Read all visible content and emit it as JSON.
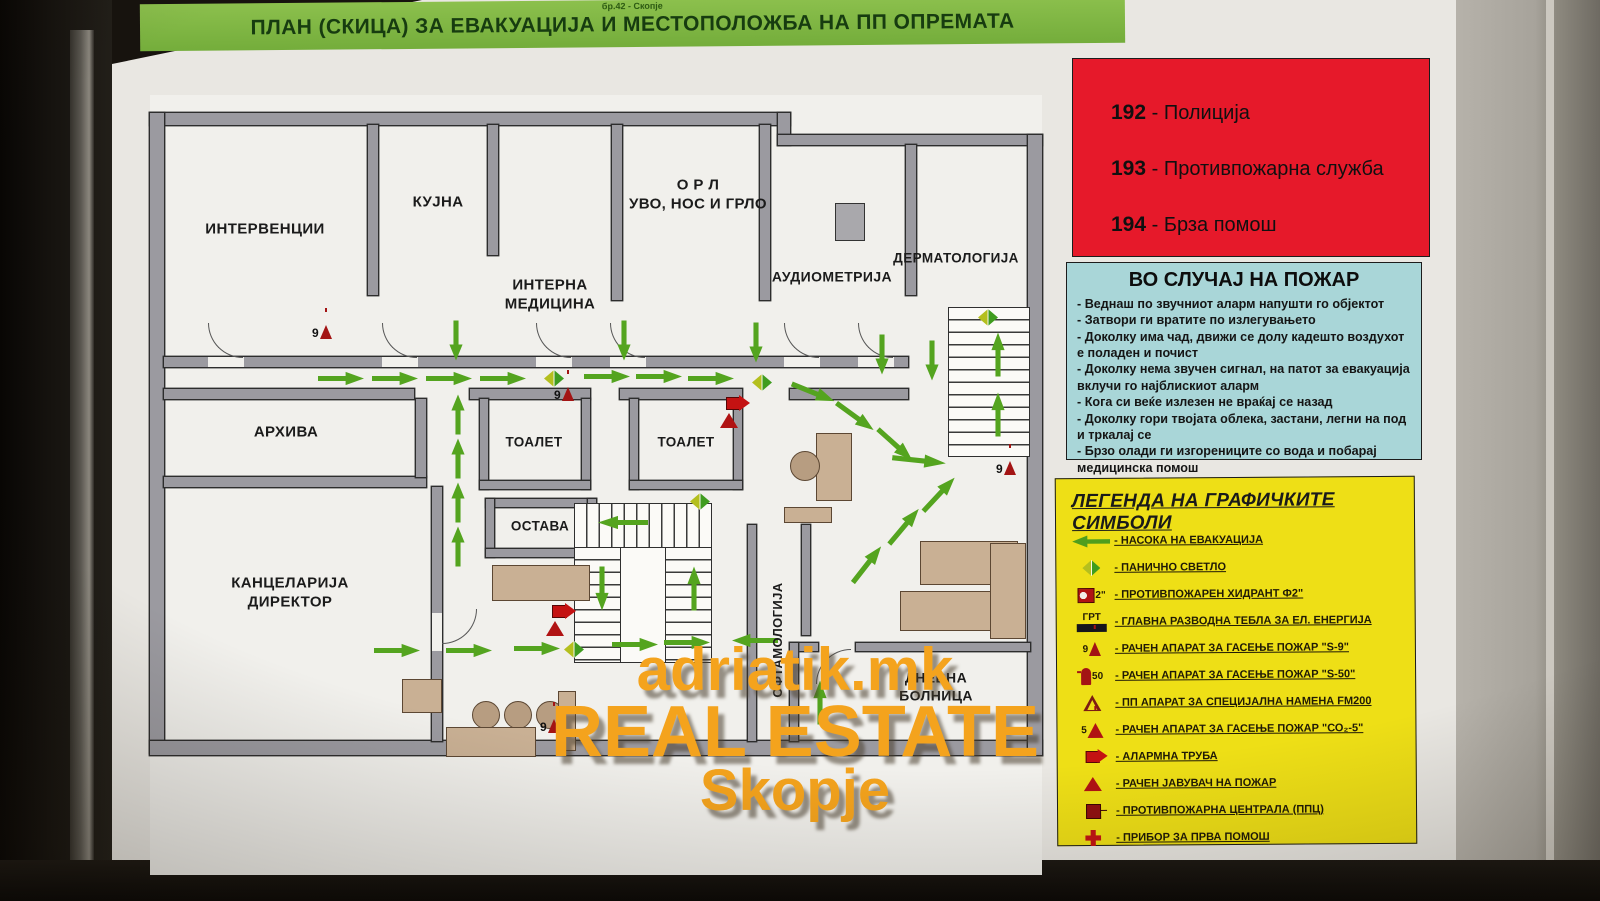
{
  "header": {
    "pretitle": "бр.42 - Скопје",
    "title": "ПЛАН (СКИЦА) ЗА ЕВАКУАЦИЈА И МЕСТОПОЛОЖБА НА ПП ОПРЕМАТА"
  },
  "emergency": {
    "separator": " - ",
    "items": [
      {
        "number": "192",
        "label": "Полиција"
      },
      {
        "number": "193",
        "label": "Противпожарна служба"
      },
      {
        "number": "194",
        "label": "Брза помош"
      }
    ]
  },
  "fire_case": {
    "title": "ВО СЛУЧАЈ НА ПОЖАР",
    "items": [
      "- Веднаш по звучниот аларм напушти го објектот",
      "- Затвори ги вратите по излегувањето",
      "- Доколку има чад, движи се долу кадешто воздухот е поладен и почист",
      "- Доколку нема звучен сигнал, на патот за евакуација вклучи го најблискиот аларм",
      "- Кога си веќе излезен не враќај се назад",
      "- Доколку гори твојата облека, застани, легни на под и тркалај се",
      "- Брзо олади ги изгорениците со вода и побарај медицинска помош"
    ]
  },
  "legend": {
    "title": "ЛЕГЕНДА НА ГРАФИЧКИТЕ СИМБОЛИ",
    "items": [
      {
        "icon": "evacuation-arrow-icon",
        "badge": "",
        "label": "- НАСОКА НА ЕВАКУАЦИЈА"
      },
      {
        "icon": "panic-light-icon",
        "badge": "",
        "label": "- ПАНИЧНО СВЕТЛО"
      },
      {
        "icon": "fire-hydrant-icon",
        "badge": "2\"",
        "label": "- ПРОТИВПОЖАРЕН ХИДРАНТ Ф2\""
      },
      {
        "icon": "electrical-board-icon",
        "badge": "ГРТ",
        "label": "- ГЛАВНА РАЗВОДНА ТЕБЛА ЗА ЕЛ. ЕНЕРГИЈА"
      },
      {
        "icon": "extinguisher-s9-icon",
        "badge": "9",
        "label": "- РАЧЕН АПАРАТ ЗА ГАСЕЊЕ ПОЖАР  \"S-9\""
      },
      {
        "icon": "extinguisher-s50-icon",
        "badge": "50",
        "label": "- РАЧЕН АПАРАТ ЗА ГАСЕЊЕ ПОЖАР  \"S-50\""
      },
      {
        "icon": "fm200-extinguisher-icon",
        "badge": "",
        "label": "- ПП АПАРАТ ЗА СПЕЦИЈАЛНА НАМЕНА  FM200"
      },
      {
        "icon": "extinguisher-co2-icon",
        "badge": "5",
        "label": "- РАЧЕН АПАРАТ ЗА ГАСЕЊЕ ПОЖАР  \"СО₂-5\""
      },
      {
        "icon": "alarm-horn-icon",
        "badge": "",
        "label": "- АЛАРМНА ТРУБА"
      },
      {
        "icon": "manual-call-point-icon",
        "badge": "",
        "label": "- РАЧЕН ЈАВУВАЧ НА ПОЖАР"
      },
      {
        "icon": "fire-central-icon",
        "badge": "",
        "label": "- ПРОТИВПОЖАРНА ЦЕНТРАЛА (ППЦ)"
      },
      {
        "icon": "first-aid-icon",
        "badge": "",
        "label": "- ПРИБОР ЗА ПРВА ПОМОШ"
      }
    ]
  },
  "plan": {
    "rooms": [
      {
        "label": "ИНТЕРВЕНЦИИ"
      },
      {
        "label": "КУЈНА"
      },
      {
        "label": "ИНТЕРНА\nМЕДИЦИНА"
      },
      {
        "label": "О Р Л\nУВО, НОС И ГРЛО"
      },
      {
        "label": "АУДИОМЕТРИЈА"
      },
      {
        "label": "ДЕРМАТОЛОГИЈА"
      },
      {
        "label": "АРХИВА"
      },
      {
        "label": "ТОАЛЕТ"
      },
      {
        "label": "ТОАЛЕТ"
      },
      {
        "label": "ОСТАВА"
      },
      {
        "label": "КАНЦЕЛАРИЈА\nДИРЕКТОР"
      },
      {
        "label": "ДНЕВНА\nБОЛНИЦА"
      },
      {
        "label": "ОФТАМОЛОГИЈА"
      }
    ],
    "markers": {
      "s9": "9"
    }
  },
  "watermark": {
    "line1": "adriatik.mk",
    "line2": "REAL ESTATE",
    "line3": "Skopje"
  },
  "colors": {
    "header_green": "#74ad3b",
    "alert_red": "#e6192a",
    "info_blue": "#a9d6d8",
    "legend_yellow": "#eedf16",
    "arrow_green": "#54a41f",
    "wall_gray": "#9b9aa0",
    "furniture_beige": "#c9b094",
    "marker_red": "#a31414",
    "watermark_orange": "#f4a31d"
  }
}
